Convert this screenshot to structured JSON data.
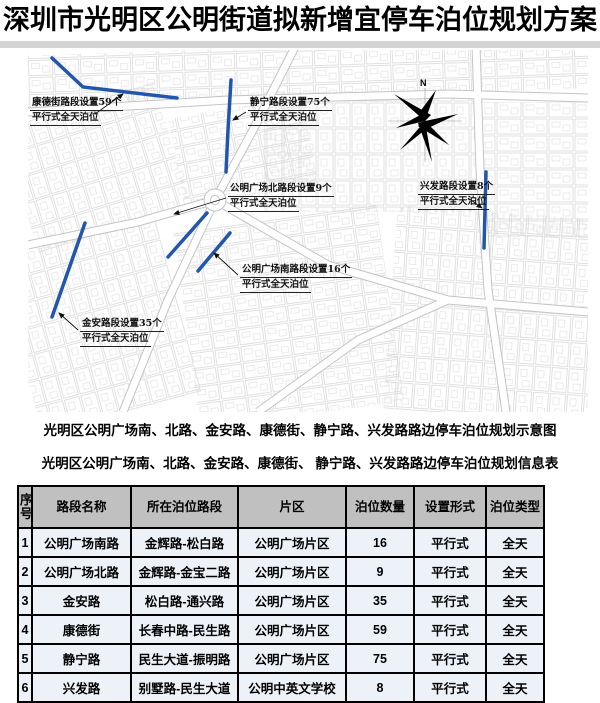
{
  "title": "深圳市光明区公明街道拟新增宜停车泊位规划方案",
  "map": {
    "north_label": "N",
    "annotations": [
      {
        "line1": "康德街路段设置59个",
        "line2": "平行式全天泊位"
      },
      {
        "line1": "静宁路段设置75个",
        "line2": "平行式全天泊位"
      },
      {
        "line1": "兴发路段设置8个",
        "line2": "平行式全天泊位"
      },
      {
        "line1": "公明广场北路段设置9个",
        "line2": "平行式全天泊位"
      },
      {
        "line1": "公明广场南路段设置16个",
        "line2": "平行式全天泊位"
      },
      {
        "line1": "金安路段设置35个",
        "line2": "平行式全天泊位"
      }
    ]
  },
  "captions": {
    "map_caption": "光明区公明广场南、北路、金安路、康德街、静宁路、兴发路路边停车泊位规划示意图",
    "table_caption": "光明区公明广场南、北路、金安路、康德街、 静宁路、兴发路路边停车泊位规划信息表"
  },
  "table": {
    "headers": [
      "序号",
      "路段名称",
      "所在泊位路段",
      "片区",
      "泊位数量",
      "设置形式",
      "泊位类型"
    ],
    "rows": [
      [
        "1",
        "公明广场南路",
        "金辉路-松白路",
        "公明广场片区",
        "16",
        "平行式",
        "全天"
      ],
      [
        "2",
        "公明广场北路",
        "金辉路-金宝二路",
        "公明广场片区",
        "9",
        "平行式",
        "全天"
      ],
      [
        "3",
        "金安路",
        "松白路-通兴路",
        "公明广场片区",
        "35",
        "平行式",
        "全天"
      ],
      [
        "4",
        "康德街",
        "长春中路-民生路",
        "公明广场片区",
        "59",
        "平行式",
        "全天"
      ],
      [
        "5",
        "静宁路",
        "民生大道-振明路",
        "公明广场片区",
        "75",
        "平行式",
        "全天"
      ],
      [
        "6",
        "兴发路",
        "别墅路-民生大道",
        "公明中英文学校",
        "8",
        "平行式",
        "全天"
      ]
    ]
  },
  "colors": {
    "road_blue": "#2256ac",
    "header_bg": "#c0c0c0",
    "cell_bg": "#edf2f9"
  }
}
